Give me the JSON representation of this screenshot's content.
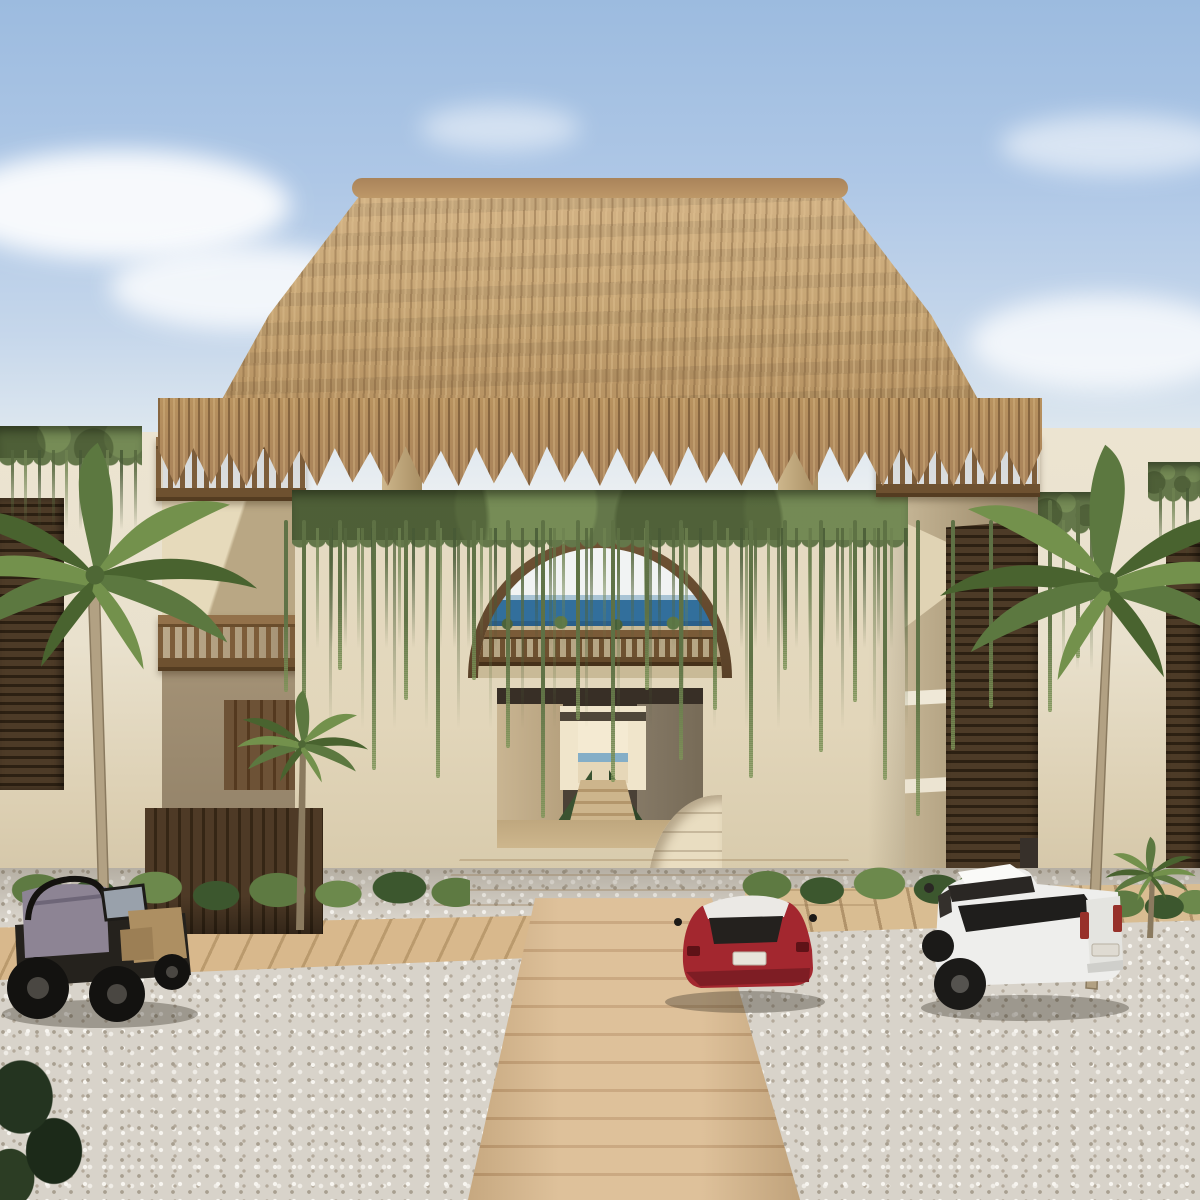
{
  "meta": {
    "title": "Beachfront resort entrance — architectural rendering",
    "type": "3d-render",
    "time_of_day": "day"
  },
  "scene": {
    "sky": "clear light-blue sky with soft white clouds",
    "roof": "palm-thatch palapa crowning the entrance tower",
    "entrance": {
      "arch": "arched upper opening with wood balustrade and ocean view",
      "corridor": "central passage with stairs leading toward the beach",
      "vines": "curtain of green vines draping the facade"
    },
    "left_wing": {
      "balconies": [
        "rooftop wood railing",
        "second-floor wood balcony"
      ],
      "screen": "dark wood louver panel",
      "fence": "dark timber slat fence at ground level"
    },
    "right_wing": {
      "bridge": "rooftop wood bridge railing over side passage",
      "screens": [
        "tall dark louver screen",
        "right-edge louver panel"
      ]
    },
    "ground": {
      "surface": "white gravel court",
      "paths": [
        "diagonal timber boardwalk strips",
        "central plank walkway"
      ],
      "planting": "row of tropical shrubs along the facade"
    },
    "palms": {
      "count": 4,
      "description": "coconut palms flanking the entrance"
    },
    "vehicles": [
      {
        "label": "open-top safari jeep",
        "color_name": "black and tan",
        "position": "far left"
      },
      {
        "label": "hatchback with white roof",
        "color_name": "red",
        "position": "right of walkway"
      },
      {
        "label": "double-cab pickup truck",
        "color_name": "white",
        "position": "right side"
      }
    ],
    "view_through_arch": "ocean horizon"
  },
  "colors": {
    "sky-top": "#9cbbdf",
    "sky-horizon": "#edf0f2",
    "cloud": "#ffffff",
    "thatch": "#c7a675",
    "thatch-light": "#d4b487",
    "thatch-fringe": "#a8825a",
    "wall": "#e9e1cd",
    "vine": "#64774a",
    "wood": "#7d5d3a",
    "ocean": "#326f9c",
    "louver": "#4d3b27",
    "louver-dark": "#2c2012",
    "interior-ceiling": "#382f26",
    "interior-left": "#c9b592",
    "interior-right": "#776b57",
    "interior-floor": "#cdb58c",
    "interior-bright": "#f0e5cb",
    "interior-green": "#3a5331",
    "gravel": "#d8d3ca",
    "gravel-dark": "#a89f90",
    "gravel-light": "#f7f5f0",
    "walk": "#d9b78a",
    "walk-line": "#c29b6d",
    "shrub": "#5e7a42",
    "shrub-dark": "#3c572e",
    "fence": "#4e3a26",
    "fence-dark": "#352615",
    "trunk": "#b2a183",
    "trunk-dark": "#8a7a5f",
    "frond": "#5c7840",
    "frond-light": "#73914c",
    "frond-dark": "#49632f",
    "jeep-body": "#25221d",
    "jeep-tan": "#ad8f62",
    "jeep-glass": "#99a1ab",
    "jeep-tarp": "#8d8494",
    "car-red": "#a3272f",
    "car-red-dark": "#7e1d24",
    "car-roof": "#ebe9e5",
    "car-glass": "#24211e",
    "truck-body": "#eeeeec",
    "truck-bed": "#1f1e1c",
    "truck-glass": "#2a2724",
    "tail-red": "#97312a"
  }
}
